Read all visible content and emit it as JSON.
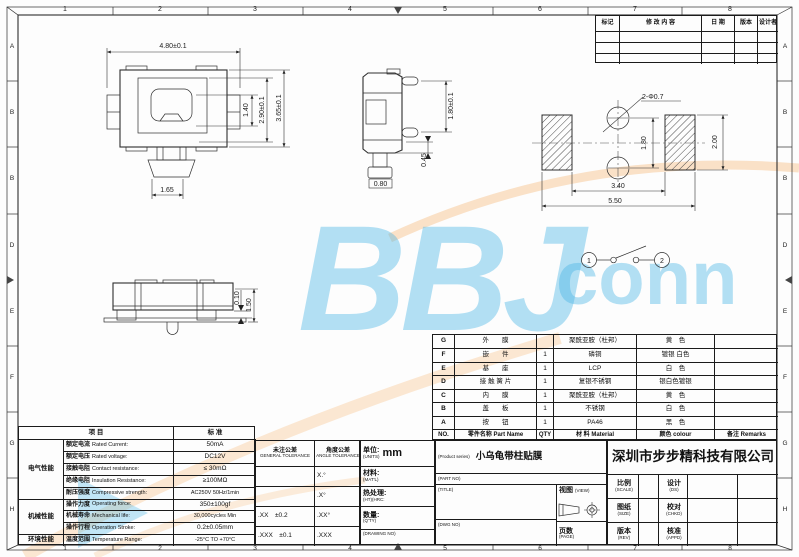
{
  "zones": {
    "top": [
      "1",
      "2",
      "3",
      "4",
      "5",
      "6",
      "7",
      "8"
    ],
    "bottom": [
      "1",
      "2",
      "3",
      "4",
      "5",
      "6",
      "7",
      "8"
    ],
    "left": [
      "A",
      "B",
      "B",
      "D",
      "E",
      "F",
      "G",
      "H"
    ],
    "right": [
      "A",
      "B",
      "B",
      "D",
      "E",
      "F",
      "G",
      "H"
    ]
  },
  "revision": {
    "headers": [
      "标记",
      "修 改 内 容",
      "日 期",
      "版本",
      "设计者"
    ]
  },
  "drawings": {
    "top_view": {
      "width": "4.80±0.1",
      "button_h": "1.40",
      "inner_h": "2.90±0.1",
      "total_h": "3.65±0.1",
      "stem_w": "1.65"
    },
    "side_view": {
      "pin_pitch": "1.80±0.1",
      "pin_off": "0.45",
      "foot_w": "0.80"
    },
    "front_view": {
      "gap": "0.10",
      "height": "1.50"
    },
    "pcb": {
      "callout": "2-Φ0.7",
      "pitch": "1.80",
      "pad_h": "2.00",
      "span_in": "3.40",
      "span_out": "5.50"
    },
    "circuit": {
      "t1": "1",
      "t2": "2"
    }
  },
  "parts": {
    "headers": {
      "no": "NO.",
      "name": "零件名称  Part Name",
      "qty": "QTY",
      "material": "材 料  Material",
      "colour": "颜色  colour",
      "remarks": "备注  Remarks"
    },
    "rows": [
      {
        "no": "G",
        "name": "外　　膜",
        "qty": "",
        "material": "聚酰亚胺（杜邦）",
        "colour": "黄　色",
        "remarks": ""
      },
      {
        "no": "F",
        "name": "嵌　　件",
        "qty": "1",
        "material": "磷铜",
        "colour": "镀银 白色",
        "remarks": ""
      },
      {
        "no": "E",
        "name": "基　　座",
        "qty": "1",
        "material": "LCP",
        "colour": "白　色",
        "remarks": ""
      },
      {
        "no": "D",
        "name": "接 触 簧 片",
        "qty": "1",
        "material": "复银不锈钢",
        "colour": "银白色镀银",
        "remarks": ""
      },
      {
        "no": "C",
        "name": "内　　膜",
        "qty": "1",
        "material": "聚酰亚胺（杜邦）",
        "colour": "黄　色",
        "remarks": ""
      },
      {
        "no": "B",
        "name": "盖　　板",
        "qty": "1",
        "material": "不锈钢",
        "colour": "白　色",
        "remarks": ""
      },
      {
        "no": "A",
        "name": "按　　钮",
        "qty": "1",
        "material": "PA46",
        "colour": "黑　色",
        "remarks": ""
      }
    ]
  },
  "spec": {
    "header_item": "项  目",
    "header_std": "标  准",
    "groups": [
      "电气性能",
      "机械性能",
      "环境性能"
    ],
    "rows": [
      {
        "cn": "额定电流",
        "en": "Rated Current:",
        "value": "50mA"
      },
      {
        "cn": "额定电压",
        "en": "Rated voltage:",
        "value": "DC12V"
      },
      {
        "cn": "接触电阻",
        "en": "Contact resistance:",
        "value": "≤ 30mΩ"
      },
      {
        "cn": "绝缘电阻",
        "en": "Insulation Resistance:",
        "value": "≥100MΩ"
      },
      {
        "cn": "耐压强度",
        "en": "Compressive strength:",
        "value": "AC250V  50Hz/1min"
      },
      {
        "cn": "操作力度",
        "en": "Operating force:",
        "value": "350±100gf"
      },
      {
        "cn": "机械寿命",
        "en": "Mechanical life:",
        "value": "30,000cycles Min"
      },
      {
        "cn": "操作行程",
        "en": "Operation Stroke:",
        "value": "0.2±0.05mm"
      },
      {
        "cn": "温度范围",
        "en": "Temperature Range:",
        "value": "-25°C TO +70°C"
      }
    ]
  },
  "tolerance": {
    "general_cn": "未注公差",
    "general_en": "GENERAL TOLERANCE",
    "angle_cn": "角度公差",
    "angle_en": "ANGLE TOLERANCE",
    "rows": [
      {
        "general": "",
        "angle": "X.°"
      },
      {
        "general": "",
        "angle": ".X°"
      },
      {
        "general": ".XX　±0.2",
        "angle": ".XX°"
      },
      {
        "general": ".XXX　±0.1",
        "angle": ".XXX"
      }
    ]
  },
  "info": {
    "unit_cn": "单位:",
    "unit_en": "(UNITS)",
    "unit_value": "mm",
    "material_cn": "材料:",
    "material_en": "(MAT'L)",
    "heat_cn": "热处理:",
    "heat_en": "(HT)(HRC:",
    "qty_cn": "数量:",
    "qty_en": "(Q'TY)",
    "drawing_no": "(DRAWING NO)"
  },
  "title_block": {
    "product_series_label": "(Product series)",
    "product_name": "小乌龟带柱贴膜",
    "part_no_label": "(PART NO)",
    "title_label": "(TITLE)",
    "dwg_no_label": "(DWG NO)",
    "view_cn": "视图",
    "view_en": "(VIEW)",
    "page_cn": "页数",
    "page_en": "(PAGE)",
    "company": "深圳市步步精科技有限公司",
    "scale_cn": "比例",
    "scale_en": "(SCALE)",
    "design_cn": "设计",
    "design_en": "(DS)",
    "size_cn": "图纸",
    "size_en": "(SIZE)",
    "check_cn": "校对",
    "check_en": "(CHKD)",
    "rev_cn": "版本",
    "rev_en": "(REV)",
    "appd_cn": "核准",
    "appd_en": "(APPD)"
  },
  "watermark": {
    "main": "BBJ",
    "sub": "conn",
    "blue": "#45b4e6",
    "orange": "#f59b3c"
  }
}
